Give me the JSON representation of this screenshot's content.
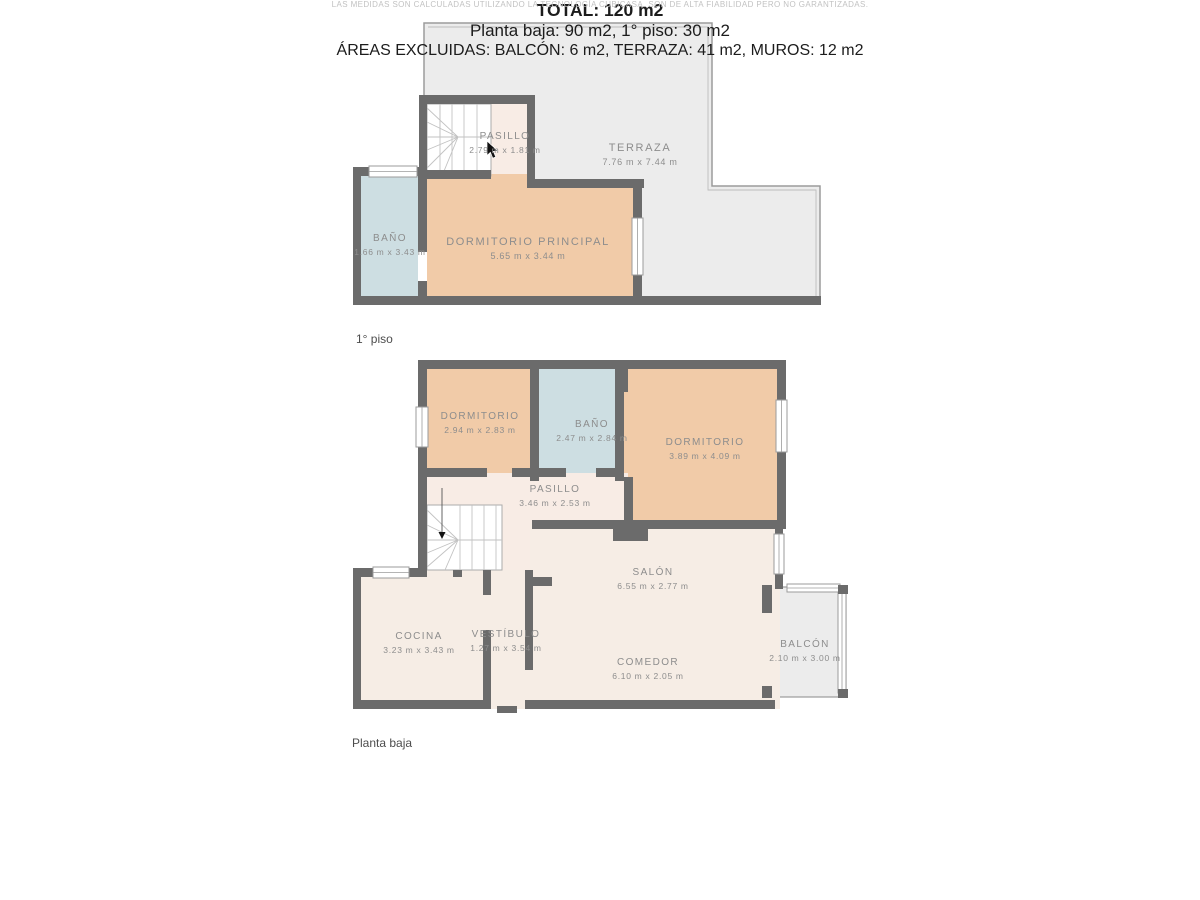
{
  "floors": [
    {
      "caption": "1° piso",
      "rooms": [
        {
          "name": "PASILLO",
          "dims": "2.79 m x 1.81 m"
        },
        {
          "name": "TERRAZA",
          "dims": "7.76 m x 7.44 m"
        },
        {
          "name": "BAÑO",
          "dims": "1.66 m x 3.43 m"
        },
        {
          "name": "DORMITORIO PRINCIPAL",
          "dims": "5.65 m x 3.44 m"
        }
      ]
    },
    {
      "caption": "Planta baja",
      "rooms": [
        {
          "name": "DORMITORIO",
          "dims": "2.94 m x 2.83 m"
        },
        {
          "name": "BAÑO",
          "dims": "2.47 m x 2.84 m"
        },
        {
          "name": "DORMITORIO",
          "dims": "3.89 m x 4.09 m"
        },
        {
          "name": "PASILLO",
          "dims": "3.46 m x 2.53 m"
        },
        {
          "name": "SALÓN",
          "dims": "6.55 m x 2.77 m"
        },
        {
          "name": "COCINA",
          "dims": "3.23 m x 3.43 m"
        },
        {
          "name": "VESTÍBULO",
          "dims": "1.27 m x 3.54 m"
        },
        {
          "name": "COMEDOR",
          "dims": "6.10 m x 2.05 m"
        },
        {
          "name": "BALCÓN",
          "dims": "2.10 m x 3.00 m"
        }
      ]
    }
  ],
  "summary": {
    "total": "TOTAL: 120 m2",
    "areas": "Planta baja: 90 m2, 1° piso: 30 m2",
    "excluded": "ÁREAS EXCLUIDAS: BALCÓN: 6 m2, TERRAZA: 41 m2, MUROS: 12 m2"
  },
  "disclaimer": "LAS MEDIDAS SON CALCULADAS UTILIZANDO LA TECNOLOGÍA CUBICASA. SON DE ALTA FIABILIDAD PERO NO GARANTIZADAS.",
  "colors": {
    "wall": "#6b6b6b",
    "bedroom": "#f1cba8",
    "bathroom": "#cddee2",
    "hallway": "#f8ece5",
    "outdoor": "#ececec",
    "outdoor_border": "#9b9b9b",
    "label_text": "#8d8d8d",
    "summary_text": "#1c1c1c",
    "disclaimer_text": "#c2c2c2"
  }
}
